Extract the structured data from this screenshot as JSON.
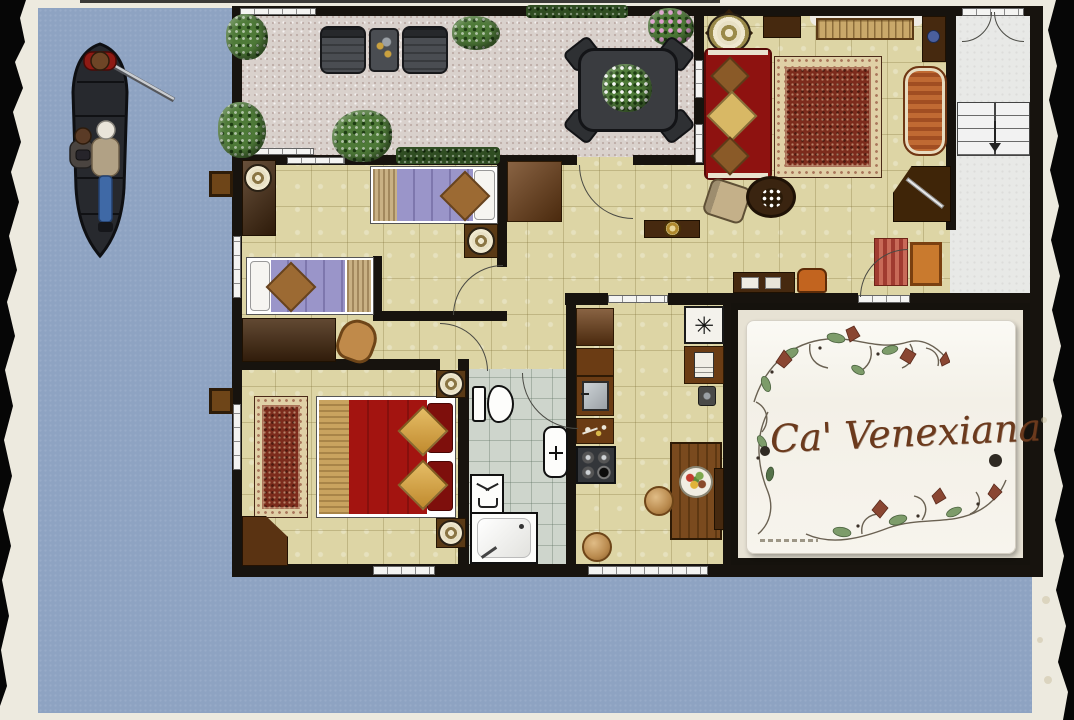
{
  "plaque": {
    "text": "Ca' Venexiana"
  },
  "icons": {
    "fan_symbol": "✳"
  },
  "palette": {
    "water": "#8ea3c2",
    "paper": "#edeadf",
    "wall": "#17130e",
    "floor_tile": "#ddd5a5",
    "terrace_stone": "#d9d1cc",
    "bathroom_tile": "#ced5cc",
    "stair_hall": "#e8e9e7",
    "sofa_red": "#8e1210",
    "bed_red": "#a31410",
    "bed_purple": "#9a95c9",
    "wood_dark": "#46290f",
    "wood_mid": "#6b3c14",
    "accent_orange": "#c06a33",
    "rug_field": "#7c2b1c",
    "rug_border": "#e0d0a6",
    "script_brown": "#6b3a1d"
  },
  "scene": {
    "setting": "canal-side apartment floor plan",
    "boat": {
      "type": "gondola",
      "occupants": [
        "gondolier with oar",
        "seated passenger",
        "standing passenger"
      ]
    },
    "rooms": [
      {
        "name": "terrace",
        "items": [
          "lounge chair",
          "side table",
          "lounge chair",
          "dining table with four chairs",
          "potted plant",
          "bushes",
          "flowering shrub",
          "hedge planters"
        ]
      },
      {
        "name": "living-room",
        "items": [
          "red sofa with cushions",
          "oriental rug",
          "round plate table",
          "radiator shelf",
          "striped chaise",
          "armchair",
          "mosaic side table",
          "sideboard",
          "orange armchair",
          "striped runner",
          "side table",
          "corner desk"
        ]
      },
      {
        "name": "entry-stair-hall",
        "items": [
          "double entrance door",
          "staircase down"
        ]
      },
      {
        "name": "twin-bedroom",
        "items": [
          "single bed",
          "single bed",
          "wardrobe with lamp",
          "desk",
          "chair",
          "bedside lamp"
        ]
      },
      {
        "name": "hallway",
        "items": [
          "wardrobe",
          "console with bowl"
        ]
      },
      {
        "name": "master-bedroom",
        "items": [
          "double bed",
          "runner rug",
          "corner wardrobe",
          "bedside lamp",
          "bedside lamp"
        ]
      },
      {
        "name": "bathroom",
        "items": [
          "toilet",
          "washbasin",
          "laundry basket",
          "shower"
        ]
      },
      {
        "name": "kitchen",
        "items": [
          "counter",
          "sink",
          "utensil drawer",
          "gas hob",
          "fan unit",
          "oven unit",
          "dining table",
          "fruit bowl",
          "stool",
          "stool"
        ]
      },
      {
        "name": "plaque-room",
        "items": [
          "ceramic name plaque",
          "floral vine decoration",
          "mounting dots",
          "artist signature"
        ]
      }
    ],
    "exterior": [
      "mooring post",
      "mooring post",
      "torn paper border"
    ]
  }
}
